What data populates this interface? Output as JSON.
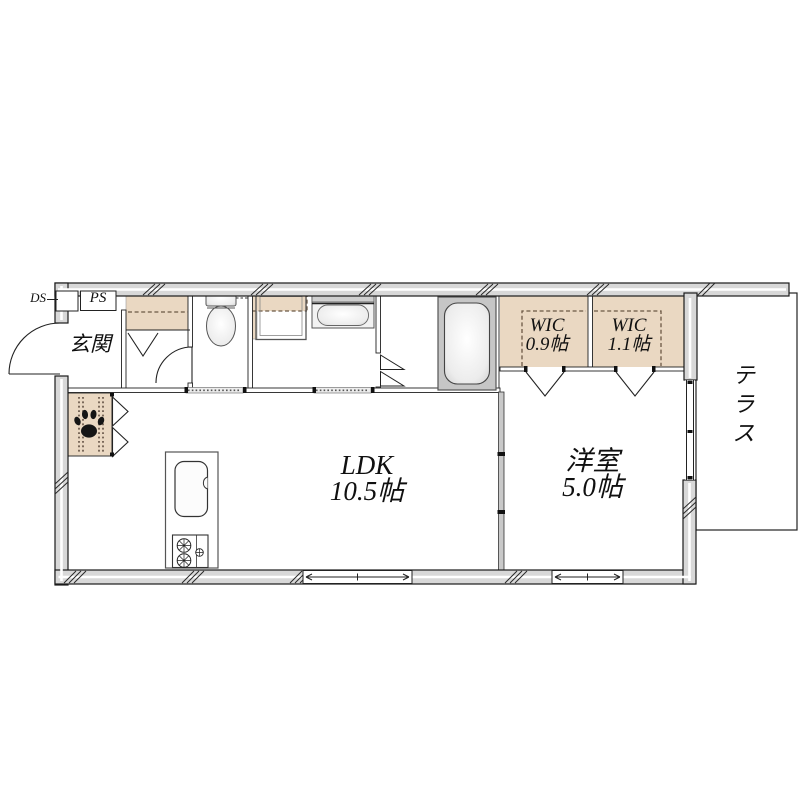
{
  "page": {
    "type": "apartment-floor-plan"
  },
  "colors": {
    "wall_fill": "#d8d8d8",
    "closet_fill": "#ead8c2",
    "outline": "#1a1a1a",
    "dash_line": "#6b5844",
    "fixture_gray": "#c6c6c6"
  },
  "labels": {
    "ds": "DS",
    "ps": "PS",
    "entrance": "玄関",
    "terrace": "テラス",
    "wic_small": {
      "name": "WIC",
      "size": "0.9帖"
    },
    "wic_large": {
      "name": "WIC",
      "size": "1.1帖"
    },
    "ldk": {
      "name": "LDK",
      "size": "10.5帖"
    },
    "western_room": {
      "name": "洋室",
      "size": "5.0帖"
    }
  },
  "symbols": {
    "fixtures": [
      "toilet",
      "washing-machine-pan",
      "vanity-sink",
      "bathtub",
      "kitchen-sink",
      "gas-stove",
      "paw-print",
      "entrance-door",
      "sliding-windows",
      "folding-doors"
    ]
  }
}
